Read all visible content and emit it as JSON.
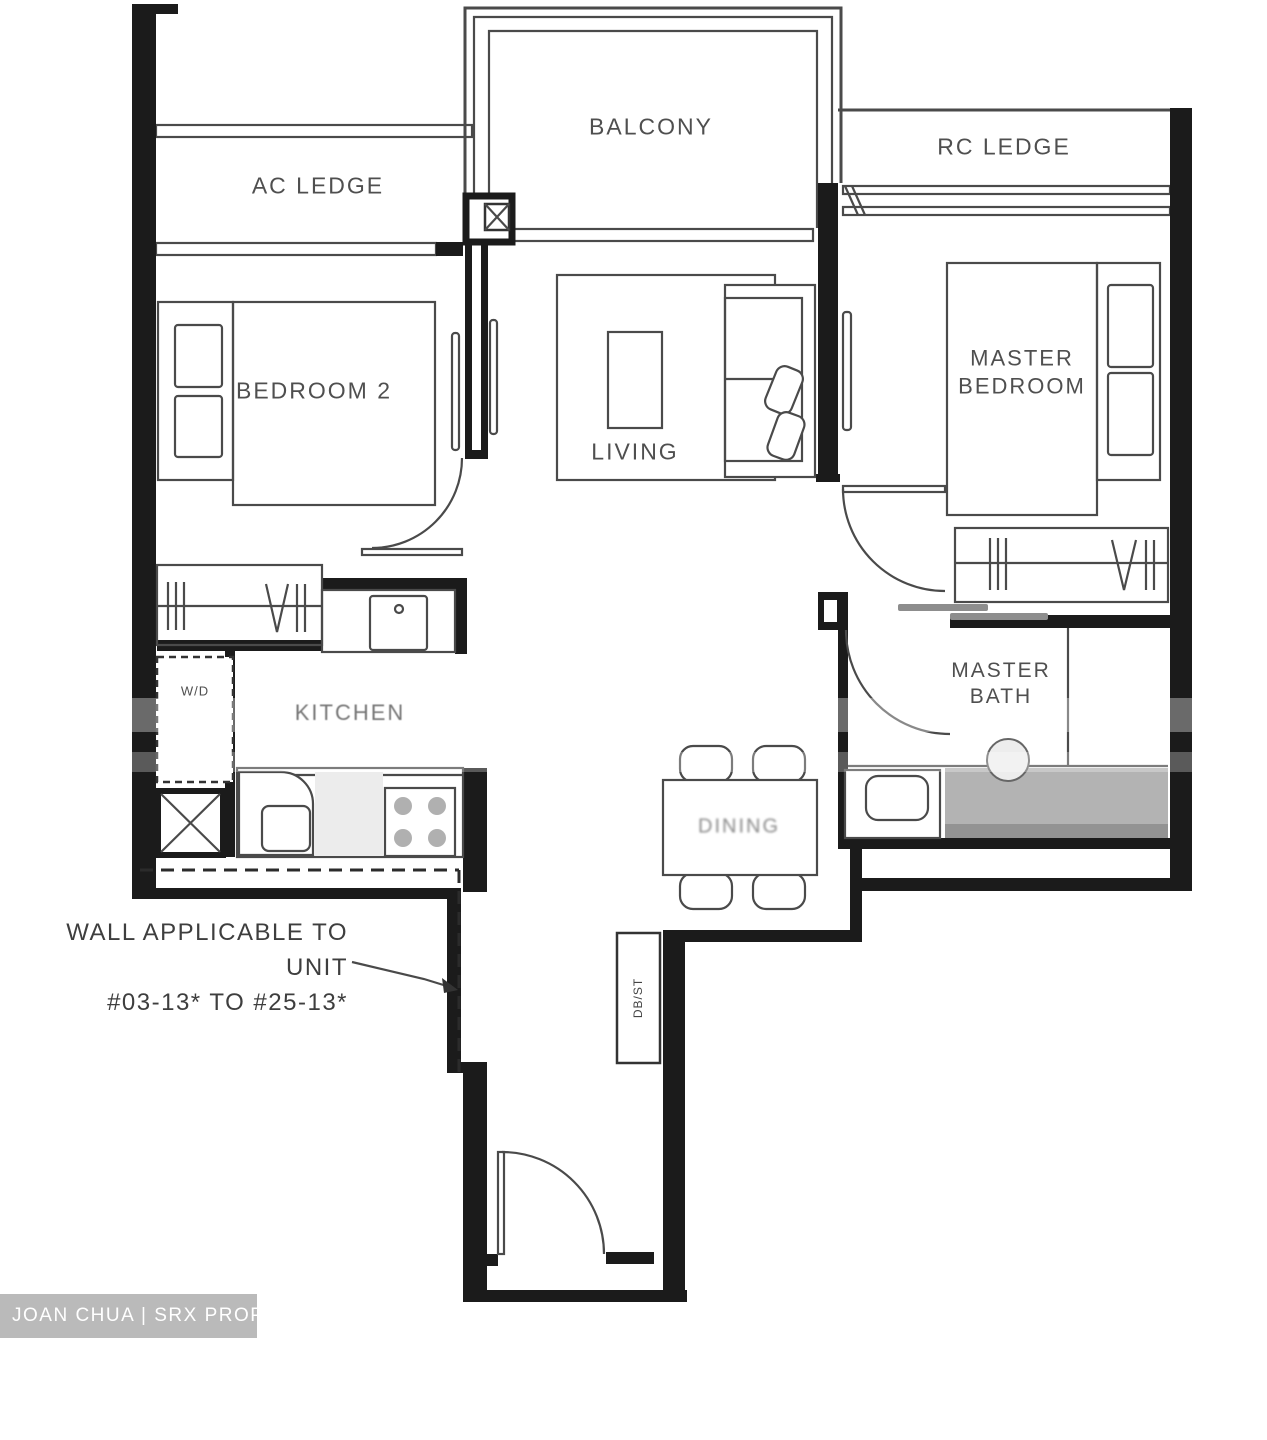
{
  "plan": {
    "labels": {
      "balcony": "BALCONY",
      "ac_ledge": "AC LEDGE",
      "rc_ledge": "RC LEDGE",
      "bedroom2": "BEDROOM 2",
      "living": "LIVING",
      "master_bedroom": "MASTER BEDROOM",
      "kitchen": "KITCHEN",
      "dining": "DINING",
      "master_bath": "MASTER BATH",
      "wd": "W/D",
      "dbst": "DB/ST"
    },
    "note": {
      "line1": "WALL APPLICABLE TO UNIT",
      "line2": "#03-13* TO #25-13*"
    },
    "watermark": {
      "text": "JOAN CHUA | SRX PROPERTY"
    },
    "colors": {
      "wall": "#1b1b1b",
      "line": "#4a4a4a",
      "label": "#4f4f4f",
      "shower": "#b3b3b3",
      "watermark_bg": "#bababa",
      "watermark_text": "#ffffff"
    }
  }
}
